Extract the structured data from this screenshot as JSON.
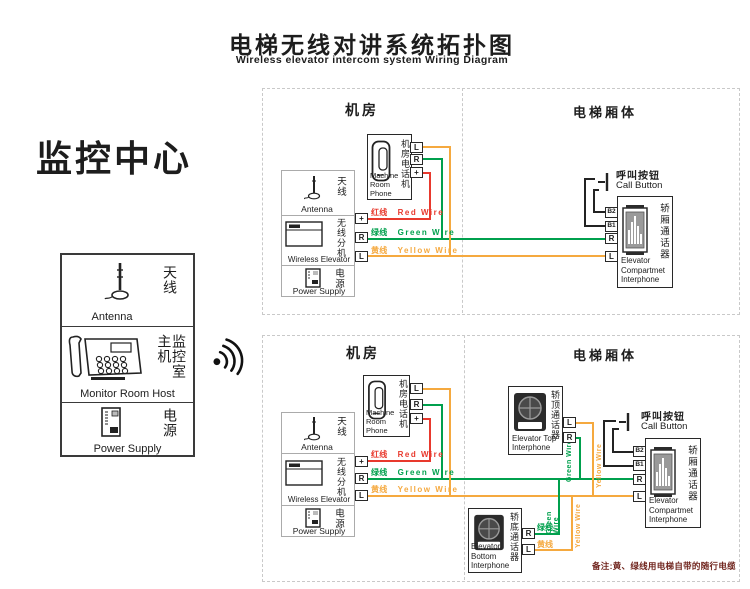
{
  "title": {
    "zh": "电梯无线对讲系统拓扑图",
    "en": "Wireless elevator intercom system Wiring Diagram"
  },
  "monitor": {
    "heading": "监控中心",
    "antenna": {
      "zh": "天线",
      "en": "Antenna"
    },
    "host": {
      "zh": "监控室主机",
      "en": "Monitor Room Host"
    },
    "power": {
      "zh": "电源",
      "en": "Power Supply"
    }
  },
  "sections": {
    "machine_room": "机房",
    "elevator_car": "电梯厢体"
  },
  "devices": {
    "phone": {
      "zh": "机房电话机",
      "en": "Machine\nRoom Phone"
    },
    "wireless": {
      "antenna_zh": "天线",
      "antenna_en": "Antenna",
      "zh": "无线分机",
      "en": "Wireless Elevator",
      "power_zh": "电源",
      "power_en": "Power Supply"
    },
    "compartment": {
      "zh": "轿厢通话器",
      "en": "Elevator\nCompartmet\nInterphone"
    },
    "top_interphone": {
      "zh": "轿顶通话器",
      "en": "Elevator Top\nInterphone"
    },
    "bottom_interphone": {
      "zh": "轿底通话器",
      "en": "Elevator Bottom\nInterphone"
    },
    "call_button": {
      "zh": "呼叫按钮",
      "en": "Call Button"
    }
  },
  "terminals": {
    "plus": "+",
    "r": "R",
    "l": "L",
    "b1": "B1",
    "b2": "B2"
  },
  "wires": {
    "red": {
      "zh": "红线",
      "en": "Red Wire",
      "color": "#e8392d"
    },
    "green": {
      "zh": "绿线",
      "en": "Green Wire",
      "color": "#00a04d"
    },
    "yellow": {
      "zh": "黄线",
      "en": "Yellow Wire",
      "color": "#f5a93f"
    }
  },
  "note": "备注:黄、绿线用电梯自带的随行电缆"
}
